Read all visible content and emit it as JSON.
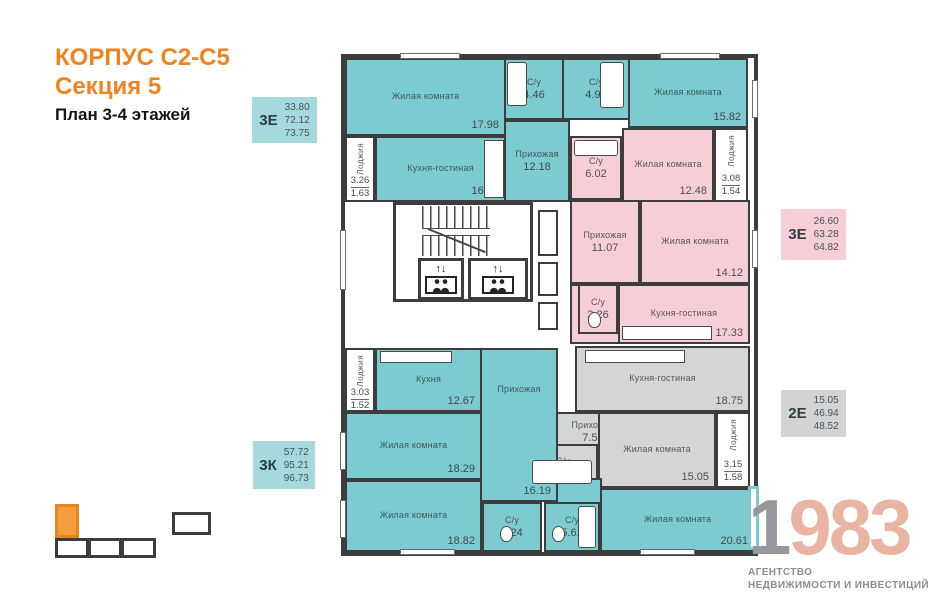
{
  "title": {
    "line1": "КОРПУС С2-С5",
    "line2": "Секция 5",
    "line3": "План 3-4 этажей"
  },
  "badges": [
    {
      "label": "3Е",
      "values": [
        "33.80",
        "72.12",
        "73.75"
      ]
    },
    {
      "label": "3Е",
      "values": [
        "26.60",
        "63.28",
        "64.82"
      ]
    },
    {
      "label": "2Е",
      "values": [
        "15.05",
        "46.94",
        "48.52"
      ]
    },
    {
      "label": "3К",
      "values": [
        "57.72",
        "95.21",
        "96.73"
      ]
    }
  ],
  "rooms": [
    {
      "name": "Жилая комната",
      "area": "17.98"
    },
    {
      "name": "С/у",
      "area": "4.46"
    },
    {
      "name": "С/у",
      "area": "4.93"
    },
    {
      "name": "Жилая комната",
      "area": "15.82"
    },
    {
      "name": "Кухня-гостиная",
      "area": "16.75"
    },
    {
      "name": "Прихожая",
      "area": "12.18"
    },
    {
      "name": "С/у",
      "area": "6.02"
    },
    {
      "name": "Жилая комната",
      "area": "12.48"
    },
    {
      "name": "Прихожая",
      "area": "11.07"
    },
    {
      "name": "Жилая комната",
      "area": "14.12"
    },
    {
      "name": "С/у",
      "area": "2.26"
    },
    {
      "name": "Кухня-гостиная",
      "area": "17.33"
    },
    {
      "name": "Кухня-гостиная",
      "area": "18.75"
    },
    {
      "name": "Прихожая",
      "area": "7.59"
    },
    {
      "name": "С/у",
      "area": "5.55"
    },
    {
      "name": "Жилая комната",
      "area": "15.05"
    },
    {
      "name": "Кухня",
      "area": "12.67"
    },
    {
      "name": "Прихожая",
      "area": "16.19"
    },
    {
      "name": "Жилая комната",
      "area": "18.29"
    },
    {
      "name": "Жилая комната",
      "area": "18.82"
    },
    {
      "name": "С/у",
      "area": "3.24"
    },
    {
      "name": "С/у",
      "area": "5.61"
    },
    {
      "name": "Жилая комната",
      "area": "20.61"
    }
  ],
  "loggias": [
    {
      "name": "Лоджия",
      "v1": "3.26",
      "v2": "1.63"
    },
    {
      "name": "Лоджия",
      "v1": "3.08",
      "v2": "1.54"
    },
    {
      "name": "Лоджия",
      "v1": "3.15",
      "v2": "1.58"
    },
    {
      "name": "Лоджия",
      "v1": "3.03",
      "v2": "1.52"
    }
  ],
  "core": {
    "elevator_arrows": "↑↓"
  },
  "logo": {
    "digit1": "1",
    "digits": "983",
    "line1": "АГЕНТСТВО",
    "line2": "НЕДВИЖИМОСТИ И ИНВЕСТИЦИЙ"
  },
  "colors": {
    "accent_orange": "#F0831F",
    "apartment_teal": "#7CCBD0",
    "apartment_pink": "#F6CED5",
    "apartment_gray": "#D4D5D7",
    "wall": "#3D3D3D",
    "badge_teal": "#A6D9DB",
    "badge_pink": "#F8CED6",
    "badge_gray": "#D2D3D5",
    "logo_salmon": "#E9B5A2",
    "logo_gray": "#96979C"
  }
}
